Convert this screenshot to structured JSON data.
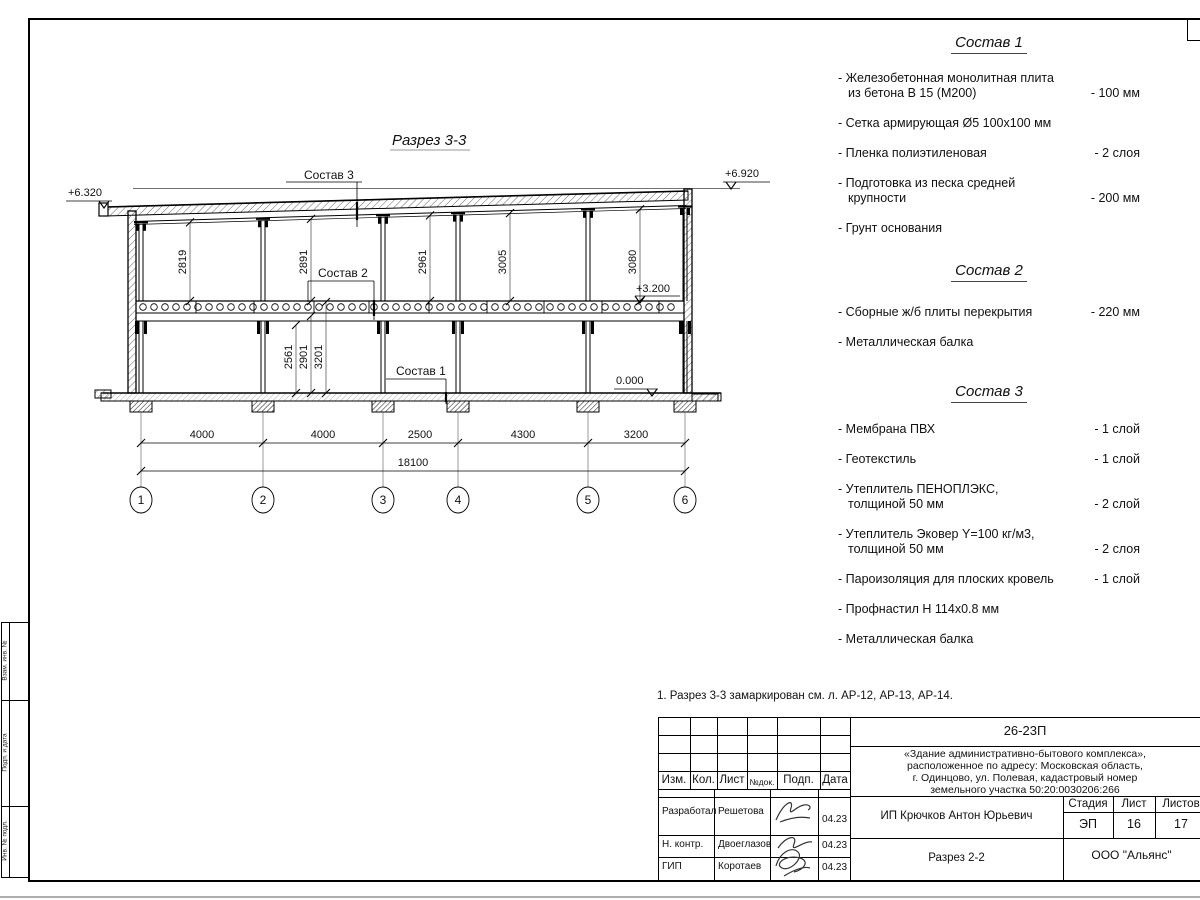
{
  "drawing": {
    "title": "Разрез 3-3",
    "labels": {
      "sostav3": "Состав 3",
      "sostav2": "Состав 2",
      "sostav1": "Состав 1"
    },
    "elevations": {
      "left": "+6.320",
      "right": "+6.920",
      "mid": "+3.200",
      "zero": "0.000"
    },
    "dims_top": [
      "2819",
      "2891",
      "2961",
      "3005",
      "3080"
    ],
    "dims_lower": [
      "2561",
      "2901",
      "3201"
    ],
    "dims_bottom": [
      "4000",
      "4000",
      "2500",
      "4300",
      "3200"
    ],
    "dim_total": "18100",
    "axes": [
      "1",
      "2",
      "3",
      "4",
      "5",
      "6"
    ]
  },
  "lists": [
    {
      "title": "Состав 1",
      "items": [
        {
          "lines": [
            "- Железобетонная  монолитная плита",
            "из бетона В 15 (М200)"
          ],
          "value": "- 100 мм"
        },
        {
          "lines": [
            "- Сетка армирующая Ø5 100х100 мм"
          ],
          "value": ""
        },
        {
          "lines": [
            "- Пленка полиэтиленовая"
          ],
          "value": "-  2 слоя"
        },
        {
          "lines": [
            "- Подготовка из песка средней",
            "крупности"
          ],
          "value": "- 200 мм"
        },
        {
          "lines": [
            "- Грунт основания"
          ],
          "value": ""
        }
      ]
    },
    {
      "title": "Состав 2",
      "items": [
        {
          "lines": [
            "- Сборные ж/б плиты перекрытия"
          ],
          "value": "- 220 мм"
        },
        {
          "lines": [
            "- Металлическая балка"
          ],
          "value": ""
        }
      ]
    },
    {
      "title": "Состав 3",
      "items": [
        {
          "lines": [
            "- Мембрана ПВХ"
          ],
          "value": "- 1 слой"
        },
        {
          "lines": [
            "- Геотекстиль"
          ],
          "value": "- 1 слой"
        },
        {
          "lines": [
            "- Утеплитель ПЕНОПЛЭКС,",
            "толщиной 50 мм"
          ],
          "value": "- 2 слой"
        },
        {
          "lines": [
            "- Утеплитель Эковер Y=100 кг/м3,",
            "толщиной 50 мм"
          ],
          "value": "- 2 слоя"
        },
        {
          "lines": [
            "- Пароизоляция для плоских кровель"
          ],
          "value": "- 1 слой"
        },
        {
          "lines": [
            "- Профнастил Н 114х0.8 мм"
          ],
          "value": ""
        },
        {
          "lines": [
            "- Металлическая балка"
          ],
          "value": ""
        }
      ]
    }
  ],
  "note": "1. Разрез 3-3 замаркирован см. л. АР-12, АР-13, АР-14.",
  "titleblock": {
    "doc_number": "26-23П",
    "project": [
      "«Здание административно-бытового комплекса»,",
      "расположенное по адресу: Московская область,",
      "г. Одинцово, ул. Полевая, кадастровый номер",
      "земельного участка 50:20:0030206:266"
    ],
    "header_cols": [
      "Изм.",
      "Кол.",
      "Лист",
      "№док.",
      "Подп.",
      "Дата"
    ],
    "stage_label": "Стадия",
    "sheet_label": "Лист",
    "sheets_label": "Листов",
    "stage": "ЭП",
    "sheet_no": "16",
    "sheets_total": "17",
    "client": "ИП Крючков Антон Юрьевич",
    "sheet_title": "Разрез 2-2",
    "company": "ООО \"Альянс\"",
    "roles": [
      {
        "role": "Разработал",
        "name": "Решетова",
        "date": "04.23"
      },
      {
        "role": "Н. контр.",
        "name": "Двоеглазов",
        "date": "04.23"
      },
      {
        "role": "ГИП",
        "name": "Коротаев",
        "date": "04.23"
      }
    ]
  },
  "margin_labels": [
    "Взам. инв. №",
    "Подп. и дата",
    "Инв. № подл."
  ]
}
